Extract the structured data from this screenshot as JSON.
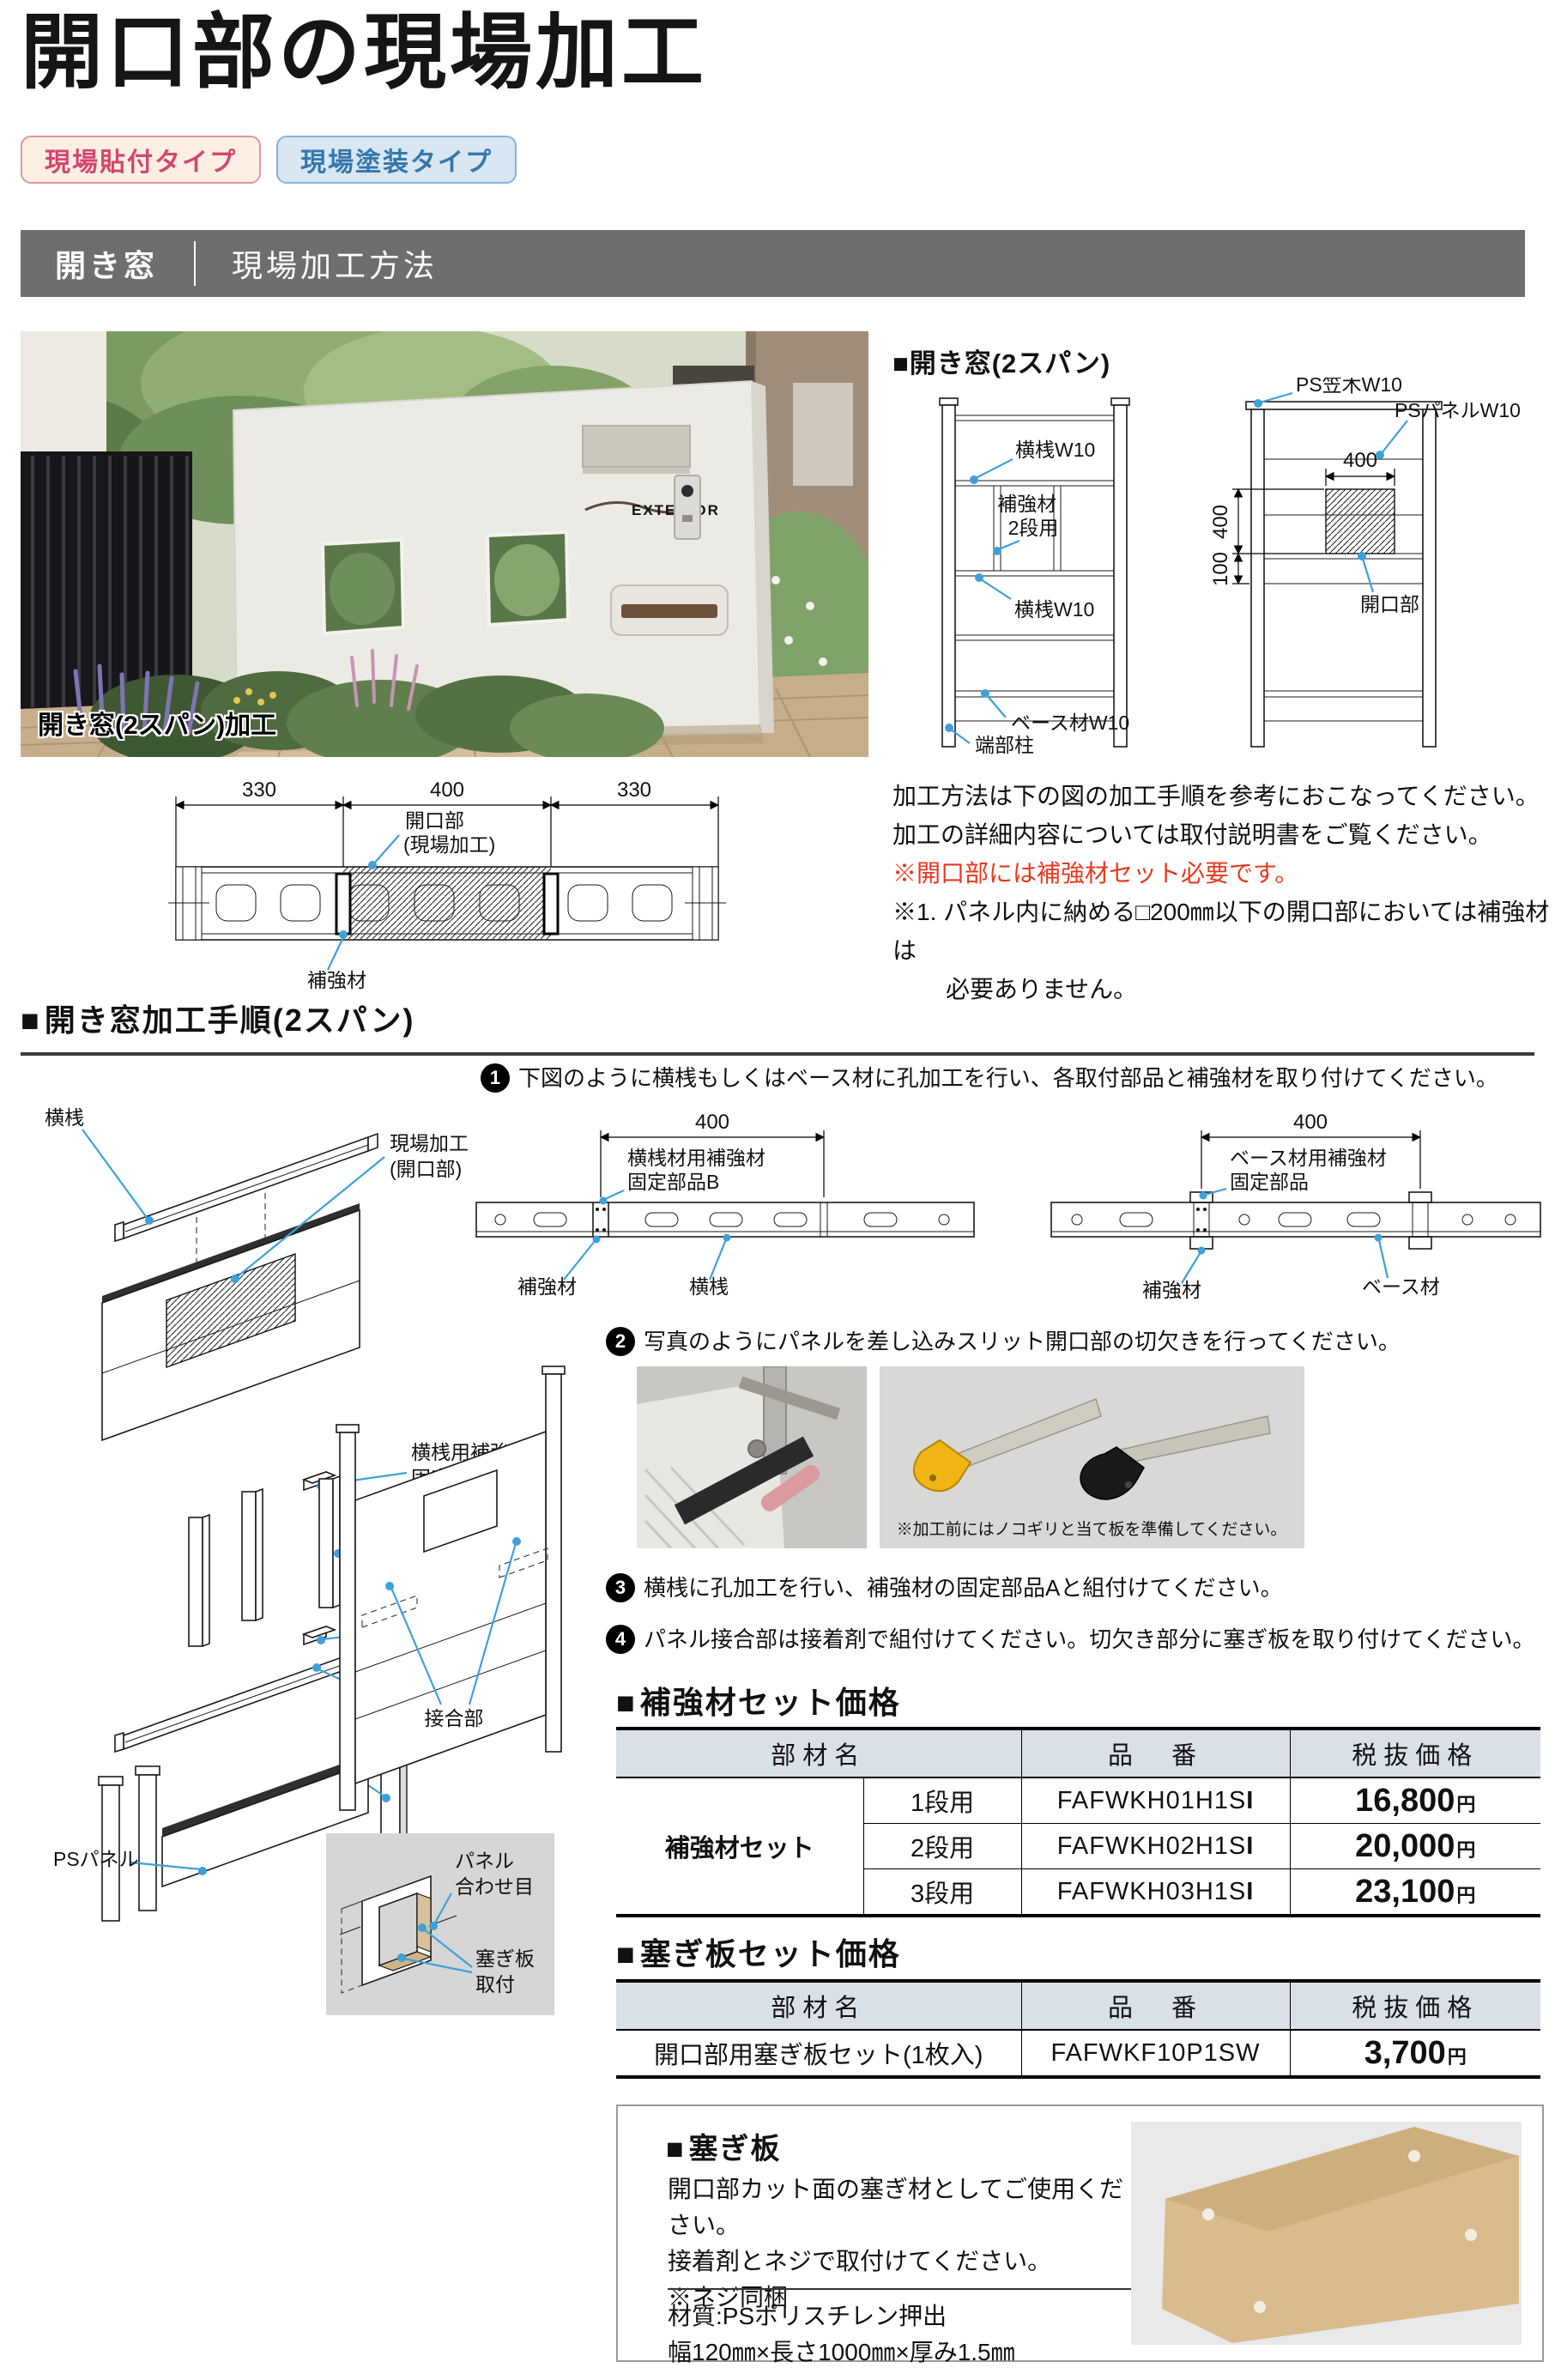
{
  "bullet": "■",
  "title": "開口部の現場加工",
  "badges": [
    {
      "label": "現場貼付タイプ"
    },
    {
      "label": "現場塗装タイプ"
    }
  ],
  "section_bar": {
    "left": "開き窓",
    "right": "現場加工方法"
  },
  "photo": {
    "caption": "開き窓(2スパン)加工",
    "sign": "EXTERIOR"
  },
  "spec": {
    "heading": "開き窓(2スパン)",
    "ladder_left": {
      "rail_top": "横桟W10",
      "reinforce_l1": "補強材",
      "reinforce_l2": "2段用",
      "rail_mid": "横桟W10",
      "base": "ベース材W10",
      "post": "端部柱"
    },
    "ladder_right": {
      "cap": "PS笠木W10",
      "panel": "PSパネルW10",
      "opening": "開口部",
      "dim_w": "400",
      "dim_h": "400",
      "dim_off": "100"
    }
  },
  "notes": {
    "line1": "加工方法は下の図の加工手順を参考におこなってください。",
    "line2": "加工の詳細内容については取付説明書をご覧ください。",
    "line3": "※開口部には補強材セット必要です。",
    "line4": "※1. パネル内に納める□200㎜以下の開口部においては補強材は",
    "line5": "必要ありません。"
  },
  "dim_diagram": {
    "d1": "330",
    "d2": "400",
    "d3": "330",
    "label_opening_1": "開口部",
    "label_opening_2": "(現場加工)",
    "label_reinforce": "補強材"
  },
  "procedure": {
    "heading": "開き窓加工手順(2スパン)",
    "steps": [
      {
        "num": "1",
        "text": "下図のように横桟もしくはベース材に孔加工を行い、各取付部品と補強材を取り付けてください。"
      },
      {
        "num": "2",
        "text": "写真のようにパネルを差し込みスリット開口部の切欠きを行ってください。"
      },
      {
        "num": "3",
        "text": "横桟に孔加工を行い、補強材の固定部品Aと組付けてください。"
      },
      {
        "num": "4",
        "text": "パネル接合部は接着剤で組付けてください。切欠き部分に塞ぎ板を取り付けてください。"
      }
    ],
    "photo_note": "※加工前にはノコギリと当て板を準備してください。",
    "diagram1": {
      "dim": "400",
      "part_l1": "横桟材用補強材",
      "part_l2": "固定部品B",
      "reinforce": "補強材",
      "member": "横桟"
    },
    "diagram2": {
      "dim": "400",
      "part_l1": "ベース材用補強材",
      "part_l2": "固定部品",
      "reinforce": "補強材",
      "member": "ベース材"
    }
  },
  "exploded": {
    "rail_top": "横桟",
    "site_l1": "現場加工",
    "site_l2": "(開口部)",
    "fixA_l1": "横桟用補強材",
    "fixA_l2": "固定部品A",
    "reinforce": "補強材2段用",
    "fixB_l1": "横桟用補強材",
    "fixB_l2": "固定部品B",
    "rail_bottom": "横桟",
    "post": "柱",
    "panel": "PSパネル",
    "joint": "接合部",
    "inset": {
      "seam_l1": "パネル",
      "seam_l2": "合わせ目",
      "plate_l1": "塞ぎ板",
      "plate_l2": "取付"
    }
  },
  "price_tables": [
    {
      "heading": "補強材セット価格",
      "col_name": "部材名",
      "col_code": "品　番",
      "col_price": "税抜価格",
      "group": "補強材セット",
      "rows": [
        {
          "size": "1段用",
          "code": "FAFWKH01H1S",
          "code_suffix": "I",
          "price": "16,800",
          "unit": "円"
        },
        {
          "size": "2段用",
          "code": "FAFWKH02H1S",
          "code_suffix": "I",
          "price": "20,000",
          "unit": "円"
        },
        {
          "size": "3段用",
          "code": "FAFWKH03H1S",
          "code_suffix": "I",
          "price": "23,100",
          "unit": "円"
        }
      ]
    },
    {
      "heading": "塞ぎ板セット価格",
      "col_name": "部材名",
      "col_code": "品　番",
      "col_price": "税抜価格",
      "rows": [
        {
          "name": "開口部用塞ぎ板セット(1枚入)",
          "code": "FAFWKF10P1SW",
          "code_suffix": "",
          "price": "3,700",
          "unit": "円"
        }
      ]
    }
  ],
  "info_box": {
    "heading": "塞ぎ板",
    "line1": "開口部カット面の塞ぎ材としてご使用ください。",
    "line2": "接着剤とネジで取付けてください。",
    "line3": "※ネジ同梱",
    "spec1": "材質:PSポリスチレン押出",
    "spec2": "幅120㎜×長さ1000㎜×厚み1.5㎜"
  },
  "colors": {
    "leader_blue": "#3fa0d9",
    "bar_gray": "#6d6e70",
    "alert_red": "#e8381e",
    "table_header_bg": "#d9e0e8",
    "badge_pink_text": "#d6456f",
    "badge_blue_text": "#3577ad"
  }
}
